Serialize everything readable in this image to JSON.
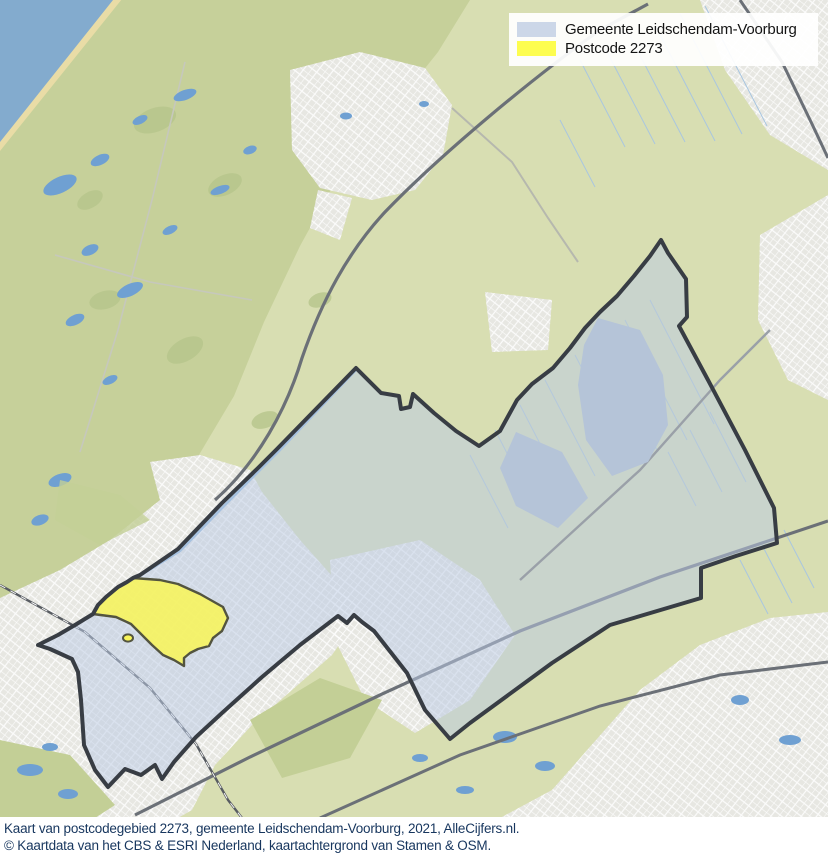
{
  "legend": {
    "items": [
      {
        "label": "Gemeente Leidschendam-Voorburg",
        "color": "#ccd7e8"
      },
      {
        "label": "Postcode 2273",
        "color": "#fdfd4f"
      }
    ]
  },
  "caption": {
    "line1": "Kaart van postcodegebied 2273, gemeente Leidschendam-Voorburg, 2021, AlleCijfers.nl.",
    "line2": "© Kaartdata van het CBS & ESRI Nederland, kaartachtergrond van Stamen & OSM."
  },
  "map": {
    "colors": {
      "municipality_fill": "#bccbe4",
      "municipality_border": "#383d44",
      "postcode_fill": "#f8f55a",
      "postcode_border": "#53543f",
      "sea": "#83abce",
      "beach": "#e9dca6",
      "dunes": "#c6d09a",
      "fields": "#d8deb2",
      "urban": "#e7e7e2",
      "forest": "#b7c68c",
      "water": "#6fa0d2",
      "lake_inside": "#b5c4d8"
    }
  }
}
